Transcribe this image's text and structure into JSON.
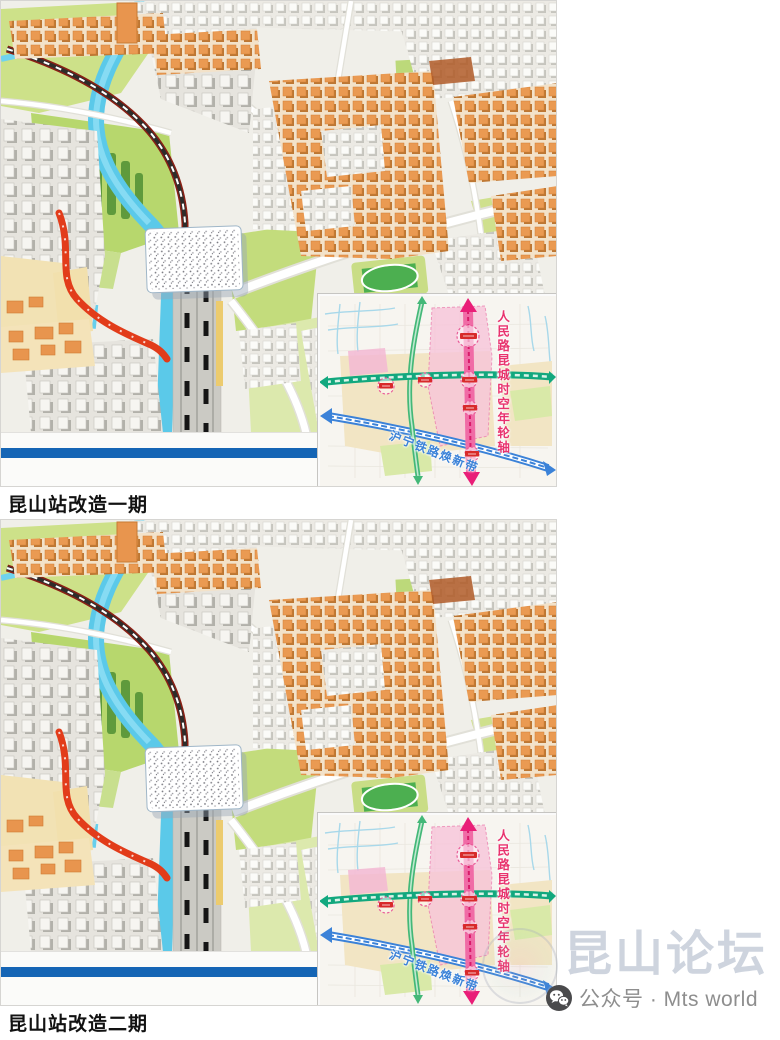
{
  "article": {
    "figures": [
      {
        "caption": "昆山站改造一期"
      },
      {
        "caption": "昆山站改造二期"
      }
    ],
    "inset_map": {
      "axis_label": "人民路昆城时空年轮轴",
      "railway_label": "沪宁铁路焕新带"
    },
    "watermark": {
      "title": "昆山论坛",
      "subtitle": "公众号 · Mts world",
      "icon": "wechat-icon"
    },
    "colors": {
      "slide_stripe_blue": "#1565b5",
      "axis_pink": "#e8336e",
      "corridor_green": "#12a87e",
      "railway_blue": "#3b82d8",
      "river_cyan": "#5bc9e9",
      "building_orange": "#e8954e",
      "watermark_gray": "#c2cad7"
    }
  }
}
